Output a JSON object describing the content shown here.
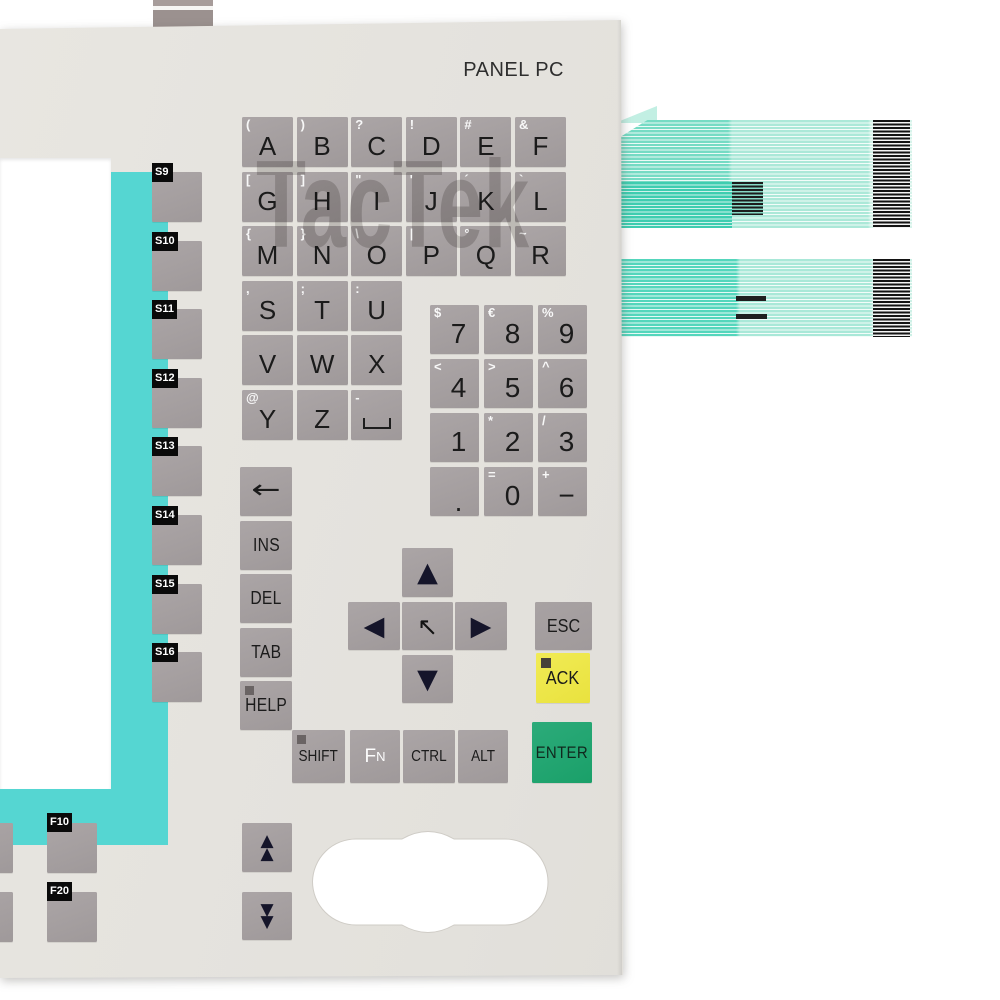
{
  "product": {
    "title": "PANEL PC",
    "watermark": "TacTek"
  },
  "colors": {
    "panel": "#E4E2DD",
    "key_gray": "#A7A1A2",
    "display_frame_teal": "#55D6D2",
    "ack_yellow": "#EDE74A",
    "enter_green": "#21A673",
    "cable_green": "#7FDCC6",
    "cable_dark_green": "#3ECDB0",
    "label_black": "#0A0A0A"
  },
  "letter_keys": [
    {
      "label": "A",
      "symbol": "(",
      "row": 0,
      "col": 0
    },
    {
      "label": "B",
      "symbol": ")",
      "row": 0,
      "col": 1
    },
    {
      "label": "C",
      "symbol": "?",
      "row": 0,
      "col": 2
    },
    {
      "label": "D",
      "symbol": "!",
      "row": 0,
      "col": 3
    },
    {
      "label": "E",
      "symbol": "#",
      "row": 0,
      "col": 4
    },
    {
      "label": "F",
      "symbol": "&",
      "row": 0,
      "col": 5
    },
    {
      "label": "G",
      "symbol": "[",
      "row": 1,
      "col": 0
    },
    {
      "label": "H",
      "symbol": "]",
      "row": 1,
      "col": 1
    },
    {
      "label": "I",
      "symbol": "\"",
      "row": 1,
      "col": 2
    },
    {
      "label": "J",
      "symbol": "'",
      "row": 1,
      "col": 3
    },
    {
      "label": "K",
      "symbol": "´",
      "row": 1,
      "col": 4
    },
    {
      "label": "L",
      "symbol": "`",
      "row": 1,
      "col": 5
    },
    {
      "label": "M",
      "symbol": "{",
      "row": 2,
      "col": 0
    },
    {
      "label": "N",
      "symbol": "}",
      "row": 2,
      "col": 1
    },
    {
      "label": "O",
      "symbol": "\\",
      "row": 2,
      "col": 2
    },
    {
      "label": "P",
      "symbol": "|",
      "row": 2,
      "col": 3
    },
    {
      "label": "Q",
      "symbol": "°",
      "row": 2,
      "col": 4
    },
    {
      "label": "R",
      "symbol": "~",
      "row": 2,
      "col": 5
    },
    {
      "label": "S",
      "symbol": ",",
      "row": 3,
      "col": 0
    },
    {
      "label": "T",
      "symbol": ";",
      "row": 3,
      "col": 1
    },
    {
      "label": "U",
      "symbol": ":",
      "row": 3,
      "col": 2
    },
    {
      "label": "V",
      "symbol": "",
      "row": 4,
      "col": 0
    },
    {
      "label": "W",
      "symbol": "",
      "row": 4,
      "col": 1
    },
    {
      "label": "X",
      "symbol": "",
      "row": 4,
      "col": 2
    },
    {
      "label": "Y",
      "symbol": "@",
      "row": 5,
      "col": 0
    },
    {
      "label": "Z",
      "symbol": "",
      "row": 5,
      "col": 1
    },
    {
      "label": "",
      "symbol": "-",
      "row": 5,
      "col": 2,
      "space": true
    }
  ],
  "numpad_keys": [
    {
      "label": "7",
      "symbol": "$",
      "row": 0,
      "col": 0
    },
    {
      "label": "8",
      "symbol": "€",
      "row": 0,
      "col": 1
    },
    {
      "label": "9",
      "symbol": "%",
      "row": 0,
      "col": 2
    },
    {
      "label": "4",
      "symbol": "<",
      "row": 1,
      "col": 0
    },
    {
      "label": "5",
      "symbol": ">",
      "row": 1,
      "col": 1
    },
    {
      "label": "6",
      "symbol": "^",
      "row": 1,
      "col": 2
    },
    {
      "label": "1",
      "symbol": "",
      "row": 2,
      "col": 0
    },
    {
      "label": "2",
      "symbol": "*",
      "row": 2,
      "col": 1
    },
    {
      "label": "3",
      "symbol": "/",
      "row": 2,
      "col": 2
    },
    {
      "label": ".",
      "symbol": "",
      "row": 3,
      "col": 0,
      "dot": true
    },
    {
      "label": "0",
      "symbol": "=",
      "row": 3,
      "col": 1
    },
    {
      "label": "−",
      "symbol": "+",
      "row": 3,
      "col": 2
    }
  ],
  "soft_keys": [
    "S9",
    "S10",
    "S11",
    "S12",
    "S13",
    "S14",
    "S15",
    "S16"
  ],
  "function_keys": [
    "F10",
    "F20"
  ],
  "control_keys": [
    {
      "glyph": "←",
      "name": "backspace"
    },
    {
      "label": "INS"
    },
    {
      "label": "DEL"
    },
    {
      "label": "TAB"
    },
    {
      "label": "HELP",
      "led": true
    }
  ],
  "arrow_keys": {
    "up": "▲",
    "left": "◀",
    "center": "↖",
    "right": "▶",
    "down": "▼"
  },
  "action_keys": {
    "esc": "ESC",
    "ack": "ACK",
    "enter": "ENTER"
  },
  "modifier_keys": [
    {
      "label": "SHIFT",
      "led": true
    },
    {
      "main": "F",
      "sub": "N"
    },
    {
      "label": "CTRL"
    },
    {
      "label": "ALT"
    }
  ],
  "page_keys": {
    "up": "▲",
    "down": "▼"
  }
}
